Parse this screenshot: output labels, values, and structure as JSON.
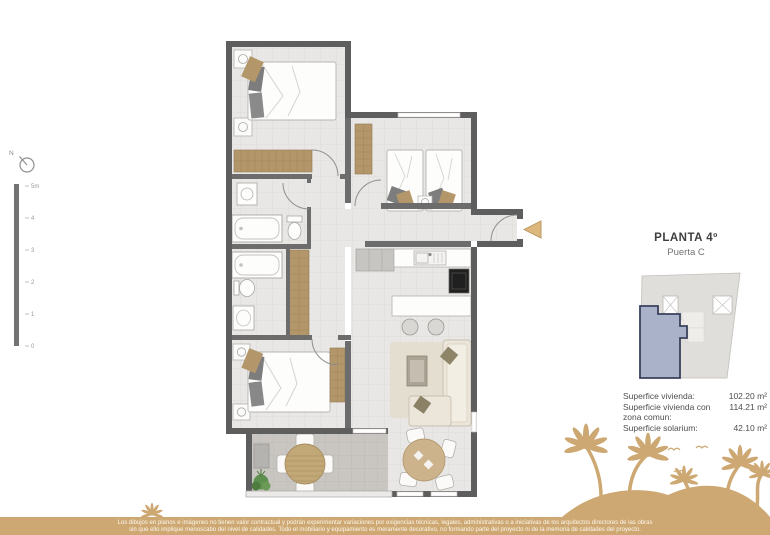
{
  "colors": {
    "accent_tan": "#cda873",
    "wall_gray": "#5e5e5e",
    "highlight_blue": "#a9b2c8",
    "floor_tile": "#e8e7e5",
    "terrace_tile": "#c9c6c2",
    "wood_tan": "#b3976a"
  },
  "compass": {
    "north_label": "N"
  },
  "scale_bar": {
    "labels": [
      "5m",
      "4",
      "3",
      "2",
      "1",
      "0"
    ]
  },
  "panel": {
    "title": "PLANTA 4º",
    "subtitle": "Puerta C",
    "surfaces": [
      {
        "label": "Superfice vivienda:",
        "value": "102.20 m²"
      },
      {
        "label": "Superficie vivienda con zona comun:",
        "value": "114.21 m²"
      },
      {
        "label": "Superficie solarium:",
        "value": "42.10 m²"
      }
    ]
  },
  "footer": {
    "disclaimer_line1": "Los dibujos en planos e imágenes no tienen valor contractual y podrán experimentar variaciones por exigencias técnicas, legales, administrativas o a iniciativas de los arquitectos directores de las obras",
    "disclaimer_line2": "sin que ello implique menoscabo del nivel de calidades. Todo el mobiliario y equipamiento es meramente decorativo, no formando parte del proyecto ni de la memoria de calidades del proyecto."
  }
}
